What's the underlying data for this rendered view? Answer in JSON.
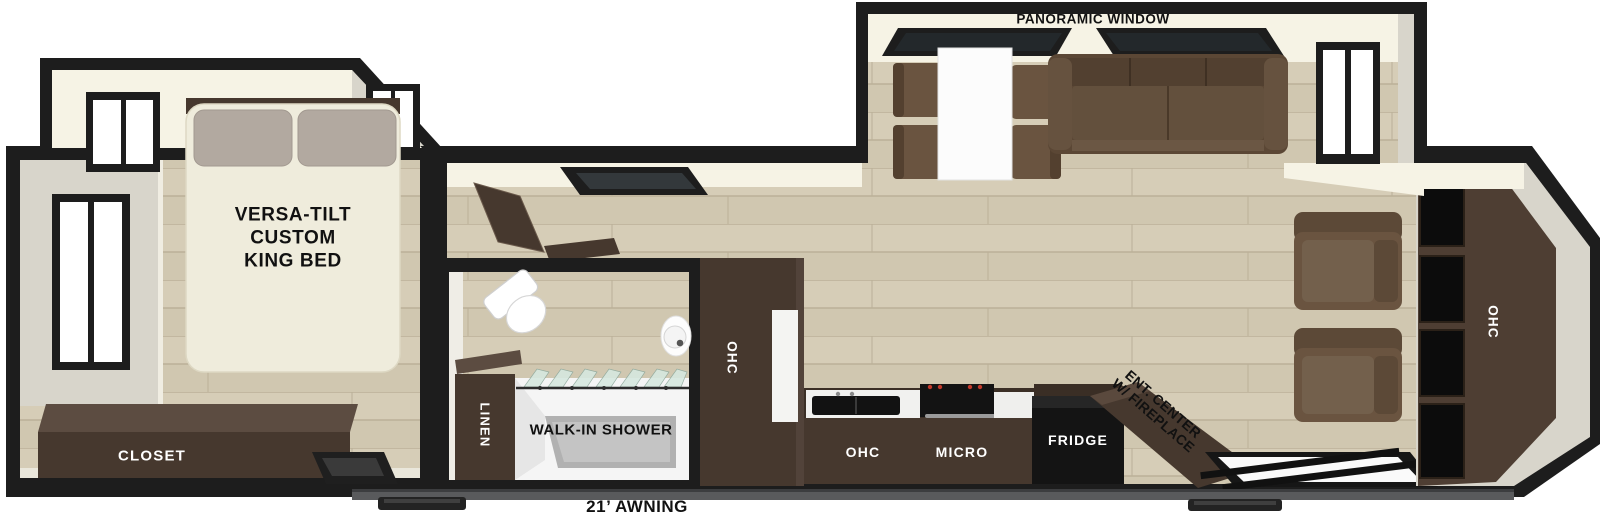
{
  "colors": {
    "wall_outline": "#1d1d1d",
    "floor_wood": "#d6cdb7",
    "floor_wood_alt": "#d0c7b0",
    "floor_line": "#bbb098",
    "wall_face": "#d8d5cb",
    "ceiling_cream": "#f6f3e5",
    "cabinet_dark": "#46382e",
    "cabinet_top": "#5c4c41",
    "sofa_brown": "#5b4735",
    "chair_brown": "#6a5440",
    "bed_ivory": "#efecdc",
    "pillow_gray": "#b2a9a0",
    "appliance_black": "#141414",
    "stove_red": "#c0392b",
    "shower_gray": "#b1b1b1",
    "glass_green": "#d6e8df",
    "awning_gray": "#595a5c",
    "label_dark": "#111111",
    "label_light": "#ffffff"
  },
  "floorplan": {
    "awning_label": "21’ AWNING",
    "bedroom": {
      "bed_label_lines": [
        "VERSA-TILT",
        "CUSTOM",
        "KING BED"
      ],
      "closet_label": "CLOSET"
    },
    "bathroom": {
      "shower_label": "WALK-IN SHOWER",
      "linen_label": "LINEN"
    },
    "kitchen": {
      "pantry_label": "OHC",
      "overhead_cabinet_label": "OHC",
      "microwave_label": "MICRO",
      "fridge_label": "FRIDGE"
    },
    "living_area": {
      "panoramic_window_label": "PANORAMIC WINDOW",
      "entertainment_center_lines": [
        "ENT. CENTER",
        "W/ FIREPLACE"
      ],
      "rear_overhead_cabinet_label": "OHC"
    }
  }
}
